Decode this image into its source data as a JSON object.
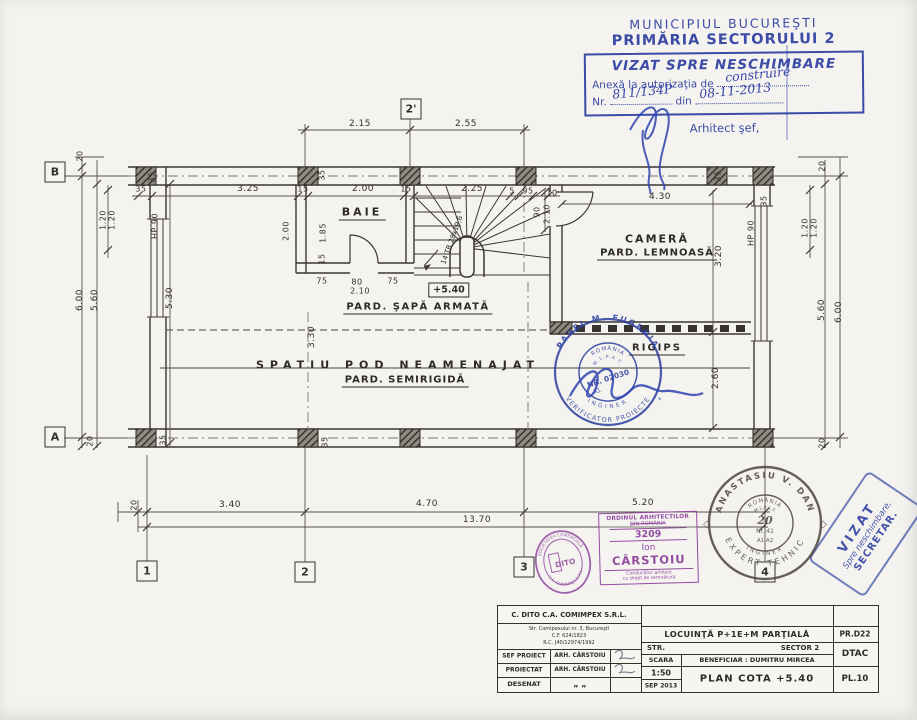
{
  "approval_stamp": {
    "line1": "MUNICIPIUL BUCUREŞTI",
    "line2": "PRIMĂRIA SECTORULUI 2",
    "box_title": "VIZAT SPRE NESCHIMBARE",
    "annex_label": "Anexă la autorizaţia de",
    "annex_value": "construire",
    "nr_label": "Nr.",
    "nr_value": "811/134P",
    "din_label": "din",
    "date_value": "08-11-2013",
    "signer_title": "Arhitect şef,"
  },
  "plan": {
    "rooms": {
      "baie": "BAIE",
      "camera_line1": "CAMERĂ",
      "camera_line2": "PARD. LEMNOASĂ",
      "floor_note": "PARD. ŞAPĂ ARMATĂ",
      "attic": "SPATIU POD NEAMENAJAT",
      "attic_floor": "PARD. SEMIRIGIDĂ",
      "rigips": "RIGIPS",
      "level": "+5.40",
      "stair_note": "14 TR 28x19,6"
    },
    "dims": [
      {
        "t": "2.15",
        "x": 360,
        "y": 124
      },
      {
        "t": "2.55",
        "x": 466,
        "y": 124
      },
      {
        "t": "35",
        "x": 141,
        "y": 189,
        "s": 8
      },
      {
        "t": "3.25",
        "x": 248,
        "y": 189
      },
      {
        "t": "15",
        "x": 303,
        "y": 189,
        "s": 8
      },
      {
        "t": "2.00",
        "x": 363,
        "y": 189
      },
      {
        "t": "15",
        "x": 406,
        "y": 189,
        "s": 8
      },
      {
        "t": "2.25",
        "x": 472,
        "y": 189
      },
      {
        "t": "5",
        "x": 512,
        "y": 191,
        "s": 8
      },
      {
        "t": "95",
        "x": 528,
        "y": 191,
        "s": 8
      },
      {
        "t": "10",
        "x": 552,
        "y": 193,
        "s": 8
      },
      {
        "t": "4.30",
        "x": 660,
        "y": 197
      },
      {
        "t": "35",
        "x": 718,
        "y": 176,
        "r": -90,
        "s": 8
      },
      {
        "t": "35",
        "x": 764,
        "y": 201,
        "r": -90,
        "s": 8
      },
      {
        "t": "35",
        "x": 322,
        "y": 175,
        "r": -90,
        "s": 8
      },
      {
        "t": "35",
        "x": 152,
        "y": 177,
        "r": -90,
        "s": 8
      },
      {
        "t": "90",
        "x": 537,
        "y": 212,
        "r": -90,
        "s": 8
      },
      {
        "t": "2.10",
        "x": 547,
        "y": 214,
        "r": -90,
        "s": 8
      },
      {
        "t": "20",
        "x": 80,
        "y": 156,
        "r": -90,
        "s": 8
      },
      {
        "t": "6.00",
        "x": 80,
        "y": 300,
        "r": -90
      },
      {
        "t": "5.60",
        "x": 95,
        "y": 300,
        "r": -90
      },
      {
        "t": "1.20",
        "x": 103,
        "y": 220,
        "r": -90,
        "s": 8
      },
      {
        "t": "1.20",
        "x": 112,
        "y": 220,
        "r": -90,
        "s": 8
      },
      {
        "t": "HP 90",
        "x": 155,
        "y": 226,
        "r": -90,
        "s": 8
      },
      {
        "t": "5.30",
        "x": 170,
        "y": 298,
        "r": -90
      },
      {
        "t": "20",
        "x": 90,
        "y": 441,
        "r": -90,
        "s": 8
      },
      {
        "t": "2.00",
        "x": 286,
        "y": 231,
        "r": -90,
        "s": 8
      },
      {
        "t": "1.85",
        "x": 323,
        "y": 233,
        "r": -90,
        "s": 8
      },
      {
        "t": "15",
        "x": 322,
        "y": 259,
        "r": -90,
        "s": 8
      },
      {
        "t": "75",
        "x": 322,
        "y": 281,
        "s": 8
      },
      {
        "t": "80",
        "x": 357,
        "y": 282,
        "s": 8
      },
      {
        "t": "75",
        "x": 393,
        "y": 281,
        "s": 8
      },
      {
        "t": "2.10",
        "x": 360,
        "y": 291,
        "s": 8
      },
      {
        "t": "3.30",
        "x": 312,
        "y": 337,
        "r": -90
      },
      {
        "t": "3.20",
        "x": 719,
        "y": 256,
        "r": -90
      },
      {
        "t": "2.60",
        "x": 716,
        "y": 378,
        "r": -90
      },
      {
        "t": "20",
        "x": 822,
        "y": 166,
        "r": -90,
        "s": 8
      },
      {
        "t": "1.20",
        "x": 805,
        "y": 228,
        "r": -90,
        "s": 8
      },
      {
        "t": "1.20",
        "x": 814,
        "y": 228,
        "r": -90,
        "s": 8
      },
      {
        "t": "5.60",
        "x": 822,
        "y": 310,
        "r": -90
      },
      {
        "t": "6.00",
        "x": 839,
        "y": 312,
        "r": -90
      },
      {
        "t": "HP 90",
        "x": 751,
        "y": 233,
        "r": -90,
        "s": 8
      },
      {
        "t": "20",
        "x": 822,
        "y": 443,
        "r": -90,
        "s": 8
      },
      {
        "t": "35",
        "x": 163,
        "y": 440,
        "r": -90,
        "s": 8
      },
      {
        "t": "35",
        "x": 325,
        "y": 442,
        "r": -90,
        "s": 8
      },
      {
        "t": "20",
        "x": 134,
        "y": 505,
        "r": -90,
        "s": 8
      },
      {
        "t": "3.40",
        "x": 230,
        "y": 505
      },
      {
        "t": "4.70",
        "x": 427,
        "y": 504
      },
      {
        "t": "5.20",
        "x": 643,
        "y": 503
      },
      {
        "t": "13.70",
        "x": 477,
        "y": 520
      }
    ],
    "grid_markers": [
      {
        "t": "B",
        "x": 55,
        "y": 172
      },
      {
        "t": "A",
        "x": 55,
        "y": 437
      },
      {
        "t": "2'",
        "x": 411,
        "y": 109
      },
      {
        "t": "1",
        "x": 147,
        "y": 571
      },
      {
        "t": "2",
        "x": 305,
        "y": 572
      },
      {
        "t": "3",
        "x": 524,
        "y": 567
      },
      {
        "t": "4",
        "x": 765,
        "y": 572
      }
    ]
  },
  "verifier_stamp": {
    "name_top": "PAVEL M. EUGENIA",
    "role_bottom": "VERIFICATOR PROIECTE",
    "role_inner": "INGINER",
    "country": "ROMÂNIA",
    "agency": "M.L.P.A.T.",
    "number": "NR. 02030",
    "grade": "A1"
  },
  "expert_stamp": {
    "name_top": "ANASTASIU V. DAN",
    "role_bottom": "EXPERT TEHNIC",
    "role_inner": "INGINER",
    "country": "ROMÂNIA",
    "agency": "M.L.P.A.T.",
    "number_hand": "20",
    "number": "Nr. 41",
    "grades": "A1 A2",
    "side_mark": "◇"
  },
  "architect_stamp": {
    "org1": "ORDINUL ARHITECTILOR",
    "org2": "DIN ROMÂNIA",
    "number": "3209",
    "first_name": "Ion",
    "last_name": "CÂRSTOIU",
    "role1": "Conducător arhitect",
    "role2": "cu drept de semnătură"
  },
  "company_stamp": {
    "ring_top": "SOCIETATEA COMERCIALĂ",
    "ring_bottom": "C.A. COMIMPEX S.R.L.",
    "center": "DITO"
  },
  "secretary_stamp": {
    "line1": "VIZAT",
    "line2": "Spre neschimbare,",
    "line3": "SECRETAR."
  },
  "title_block": {
    "company": "C. DITO C.A. COMIMPEX S.R.L.",
    "address": "Str. Comipexului nr. 3, Bucureşti",
    "cf": "C.F. 624/1823",
    "rc": "R.C. J40/12974/1992",
    "rows": [
      {
        "label": "SEF PROIECT",
        "value": "ARH. CÂRSTOIU"
      },
      {
        "label": "PROIECTAT",
        "value": "ARH. CÂRSTOIU"
      },
      {
        "label": "DESENAT",
        "value": "„   „"
      }
    ],
    "project": "LOCUINŢĂ P+1E+M PARŢIALĂ",
    "project_code": "PR.D22",
    "street_label": "STR.",
    "sector": "SECTOR 2",
    "scale_label": "SCARA",
    "scale": "1:50",
    "date": "SEP 2013",
    "beneficiary": "BENEFICIAR : DUMITRU MIRCEA",
    "phase": "DTAC",
    "sheet_title": "PLAN COTA +5.40",
    "sheet_no": "PL.10"
  }
}
